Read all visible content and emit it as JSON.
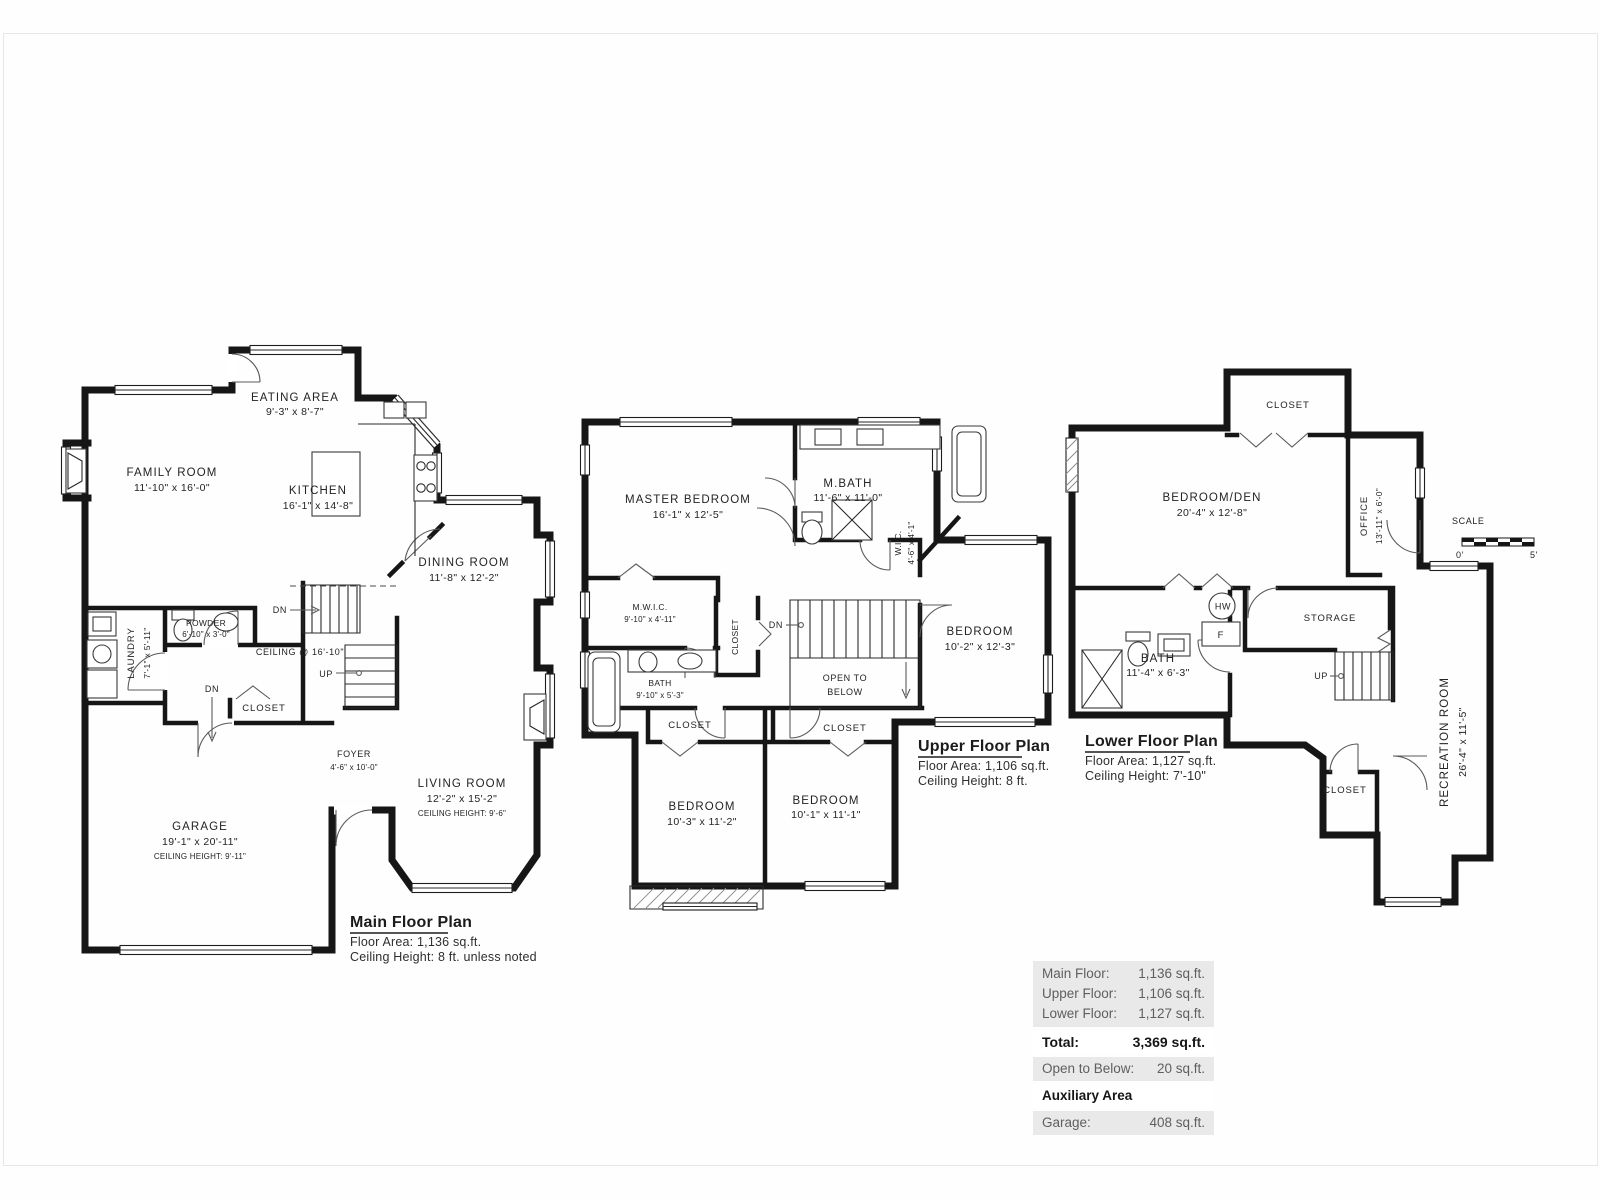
{
  "plans": {
    "main": {
      "title": "Main Floor Plan",
      "area": "Floor Area: 1,136 sq.ft.",
      "ceiling": "Ceiling Height: 8 ft. unless noted",
      "rooms": {
        "eating": {
          "name": "EATING AREA",
          "dims": "9'-3\" x 8'-7\""
        },
        "family": {
          "name": "FAMILY ROOM",
          "dims": "11'-10\" x 16'-0\""
        },
        "kitchen": {
          "name": "KITCHEN",
          "dims": "16'-1\" x 14'-8\""
        },
        "dining": {
          "name": "DINING ROOM",
          "dims": "11'-8\" x 12'-2\""
        },
        "laundry": {
          "name": "LAUNDRY",
          "dims": "7'-1\" x 5'-11\""
        },
        "powder": {
          "name": "POWDER",
          "dims": "6'-10\" x 3'-0\""
        },
        "closet": {
          "name": "CLOSET"
        },
        "foyer": {
          "name": "FOYER",
          "dims": "4'-6\" x 10'-0\""
        },
        "living": {
          "name": "LIVING ROOM",
          "dims": "12'-2\" x 15'-2\"",
          "ceiling": "CEILING HEIGHT: 9'-6\""
        },
        "garage": {
          "name": "GARAGE",
          "dims": "19'-1\" x 20'-11\"",
          "ceiling": "CEILING HEIGHT: 9'-11\""
        }
      },
      "notes": {
        "ceiling_open": "CEILING @ 16'-10\"",
        "dn": "DN",
        "up": "UP",
        "dn2": "DN",
        "w": "W",
        "d": "D"
      }
    },
    "upper": {
      "title": "Upper Floor Plan",
      "area": "Floor Area: 1,106 sq.ft.",
      "ceiling": "Ceiling Height: 8 ft.",
      "rooms": {
        "master": {
          "name": "MASTER BEDROOM",
          "dims": "16'-1\" x 12'-5\""
        },
        "mbath": {
          "name": "M.BATH",
          "dims": "11'-6\" x 11'-0\""
        },
        "wic": {
          "name": "W.I.C.",
          "dims": "4'-6\" x 4'-1\""
        },
        "mwic": {
          "name": "M.W.I.C.",
          "dims": "9'-10\" x 4'-11\""
        },
        "closet_hall": {
          "name": "CLOSET"
        },
        "bath": {
          "name": "BATH",
          "dims": "9'-10\" x 5'-3\""
        },
        "bedroom_e": {
          "name": "BEDROOM",
          "dims": "10'-2\" x 12'-3\""
        },
        "open_below_1": "OPEN TO",
        "open_below_2": "BELOW",
        "closet_l": {
          "name": "CLOSET"
        },
        "closet_r": {
          "name": "CLOSET"
        },
        "bedroom_sw": {
          "name": "BEDROOM",
          "dims": "10'-3\" x 11'-2\""
        },
        "bedroom_se": {
          "name": "BEDROOM",
          "dims": "10'-1\" x 11'-1\""
        }
      },
      "notes": {
        "dn": "DN"
      }
    },
    "lower": {
      "title": "Lower Floor Plan",
      "area": "Floor Area: 1,127 sq.ft.",
      "ceiling": "Ceiling Height: 7'-10\"",
      "rooms": {
        "closet_top": {
          "name": "CLOSET"
        },
        "den": {
          "name": "BEDROOM/DEN",
          "dims": "20'-4\" x 12'-8\""
        },
        "office": {
          "name": "OFFICE",
          "dims": "13'-11\" x 6'-0\""
        },
        "storage": {
          "name": "STORAGE"
        },
        "bath": {
          "name": "BATH",
          "dims": "11'-4\" x 6'-3\""
        },
        "rec": {
          "name": "RECREATION ROOM",
          "dims": "26'-4\" x 11'-5\""
        },
        "closet_bottom": {
          "name": "CLOSET"
        },
        "hw": "HW",
        "f": "F"
      },
      "notes": {
        "up": "UP"
      }
    }
  },
  "scale_bar": {
    "label": "SCALE",
    "from": "0'",
    "to": "5'"
  },
  "summary": {
    "floors": [
      {
        "label": "Main Floor:",
        "value": "1,136 sq.ft."
      },
      {
        "label": "Upper Floor:",
        "value": "1,106 sq.ft."
      },
      {
        "label": "Lower Floor:",
        "value": "1,127 sq.ft."
      }
    ],
    "total": {
      "label": "Total:",
      "value": "3,369 sq.ft."
    },
    "open_below": {
      "label": "Open to Below:",
      "value": "20 sq.ft."
    },
    "aux_header": "Auxiliary Area",
    "garage": {
      "label": "Garage:",
      "value": "408 sq.ft."
    }
  }
}
